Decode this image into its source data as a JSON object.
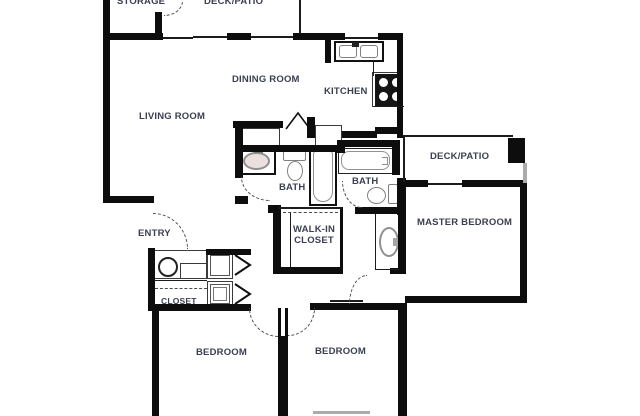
{
  "palette": {
    "wall": "#0d0d0d",
    "label_text": "#3b4050",
    "fixture_outline": "#909090",
    "sink_fill": "#ecdfdf",
    "background": "#ffffff"
  },
  "rooms": {
    "storage": "STORAGE",
    "deck_patio_top": "DECK/PATIO",
    "dining_room": "DINING ROOM",
    "kitchen": "KITCHEN",
    "living_room": "LIVING ROOM",
    "deck_patio_right": "DECK/PATIO",
    "bath_left": "BATH",
    "bath_right": "BATH",
    "master_bedroom": "MASTER BEDROOM",
    "entry": "ENTRY",
    "walk_in_closet_line1": "WALK-IN",
    "walk_in_closet_line2": "CLOSET",
    "closet": "CLOSET",
    "bedroom_left": "BEDROOM",
    "bedroom_right": "BEDROOM"
  },
  "appliances": {
    "dryer": "D",
    "washer": "W"
  }
}
